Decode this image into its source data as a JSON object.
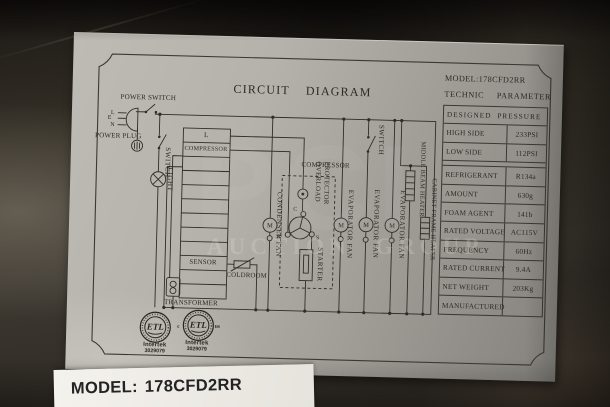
{
  "label": {
    "title": "CIRCUIT  DIAGRAM",
    "diagram": {
      "power_switch": "POWER SWITCH",
      "power_plug": "POWER PLUG",
      "pin_l": "L",
      "pin_e": "E",
      "pin_n": "N",
      "switch_left": "SWITCH",
      "light": "LIGHT",
      "terminal_l": "L",
      "terminal_compressor": "COMPRESSOR",
      "sensor": "SENSOR",
      "coldroom": "COLDROOM",
      "transformer": "TRANSFORMER",
      "condenser_fan": "CONDENSER FAN",
      "compressor_unit": "COMPRESSOR",
      "overload_protector": "OVERLOAD PROTECTOR",
      "starter": "STARTER",
      "motor_letter": "M",
      "terminal_c": "C",
      "terminal_r": "R",
      "terminal_s": "S",
      "evaporator_fan_1": "EVAPORATOR FAN",
      "evaporator_fan_2": "EVAPORATOR FAN",
      "evaporator_fan_3": "EVAPORATOR FAN",
      "switch_right": "SWITCH",
      "middle_beam_heater": "MIDDLE BEAM HEATER",
      "cabinet_frame_heater": "CABINET FRAME HEATER"
    },
    "tech_table": {
      "model": "MODEL:178CFD2RR",
      "header": "TECHNIC PARAMETER",
      "section": "DESIGNED PRESSURE",
      "rows": [
        {
          "label": "HIGH SIDE",
          "value": "233PSI"
        },
        {
          "label": "LOW SIDE",
          "value": "112PSI"
        },
        {
          "label": "REFRIGERANT",
          "value": "R134a"
        },
        {
          "label": "AMOUNT",
          "value": "630g"
        },
        {
          "label": "FOAM AGENT",
          "value": "141b"
        },
        {
          "label": "RATED VOLTAGE",
          "value": "AC115V"
        },
        {
          "label": "FREQUENCY",
          "value": "60Hz"
        },
        {
          "label": "RATED CURRENT",
          "value": "9.4A"
        },
        {
          "label": "NET WEIGHT",
          "value": "203Kg"
        },
        {
          "label": "MANUFACTURED",
          "value": ""
        }
      ]
    },
    "certifications": {
      "etl": "ETL",
      "intertek": "Intertek",
      "number": "3029079",
      "c_mark": "c",
      "us_mark": "us"
    }
  },
  "watermark": {
    "big": "PCI",
    "line": "AUCTION GROUP"
  },
  "sticker": {
    "model_label": "MODEL:",
    "model_value": "178CFD2RR"
  },
  "colors": {
    "paper": "#b5b2ab",
    "ink": "#2b2a25",
    "metal_dark": "#16130f"
  }
}
